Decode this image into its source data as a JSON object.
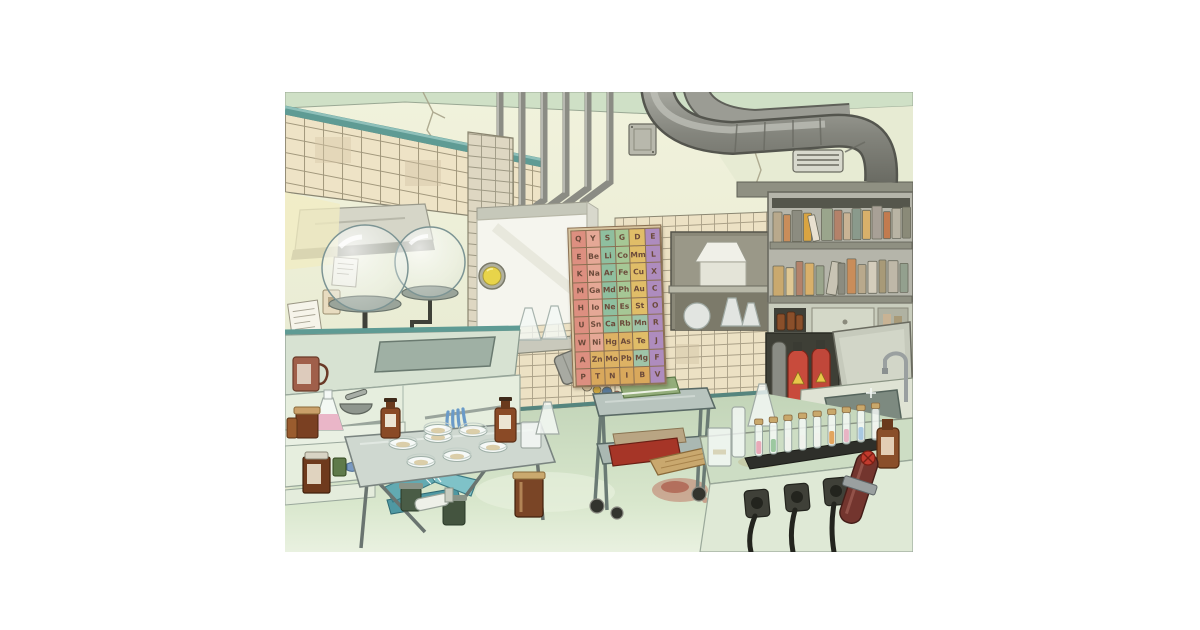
{
  "scene": {
    "title": "Laboratory illustration",
    "style": "watercolor cartoon",
    "setting": "old chemistry laboratory room with tiled walls, ducts, workbenches and glassware"
  },
  "palette": {
    "page_background": "#ffffff",
    "wall": "#eef0da",
    "wall_shadow": "#e3e7cd",
    "ceiling": "#cfe0c6",
    "tile": "#eee3c6",
    "tile_grout": "#958b70",
    "teal_trim": "#5f9b94",
    "metal": "#8b8c85",
    "metal_dark": "#5f6059",
    "counter": "#dde8d6",
    "cabinet": "#e6eede",
    "floor": "#c9dbbf",
    "extinguisher_red": "#c84b3c",
    "amber_glass": "#8a4f2a",
    "book_green": "#93ad7a",
    "book_teal": "#5fa8b0",
    "stain_red": "#b23a2a",
    "porthole_yellow": "#e8d44a",
    "agar": "#d8c9a0",
    "wood": "#c9a86e"
  },
  "poster": {
    "name": "letter-grid-wall-chart",
    "rows": 9,
    "columns": 6,
    "letter_color": "#6b4a3a",
    "column_colors": [
      "#dd8f80",
      "#e5a896",
      "#8fbf9f",
      "#a6c795",
      "#e0bd68",
      "#ae8cbe"
    ],
    "cell_overrides": [
      {
        "row": 5,
        "col": 4,
        "color": "#9fc4a8"
      },
      {
        "row": 6,
        "col": 2,
        "color": "#ddb264"
      },
      {
        "row": 6,
        "col": 3,
        "color": "#ddb264"
      },
      {
        "row": 7,
        "col": 1,
        "color": "#ddb264"
      },
      {
        "row": 7,
        "col": 2,
        "color": "#ddb264"
      },
      {
        "row": 7,
        "col": 3,
        "color": "#ddb264"
      },
      {
        "row": 7,
        "col": 4,
        "color": "#9fc4a8"
      },
      {
        "row": 8,
        "col": 1,
        "color": "#d9a85c"
      },
      {
        "row": 8,
        "col": 2,
        "color": "#d9a85c"
      },
      {
        "row": 8,
        "col": 3,
        "color": "#d9a85c"
      },
      {
        "row": 8,
        "col": 4,
        "color": "#d9a85c"
      }
    ],
    "grid": [
      [
        "Q",
        "Y",
        "S",
        "G",
        "D",
        "E"
      ],
      [
        "E",
        "Be",
        "Li",
        "Co",
        "Mm",
        "L"
      ],
      [
        "K",
        "Na",
        "Ar",
        "Fe",
        "Cu",
        "X"
      ],
      [
        "M",
        "Ga",
        "Md",
        "Ph",
        "Au",
        "C"
      ],
      [
        "H",
        "Io",
        "Ne",
        "Es",
        "St",
        "O"
      ],
      [
        "U",
        "Sn",
        "Ca",
        "Rb",
        "Mn",
        "R"
      ],
      [
        "W",
        "Ni",
        "Hg",
        "As",
        "Te",
        "J"
      ],
      [
        "A",
        "Zn",
        "Mo",
        "Pb",
        "Mg",
        "F"
      ],
      [
        "P",
        "T",
        "N",
        "I",
        "B",
        "V"
      ]
    ]
  },
  "bookshelf": {
    "row1_spines": [
      "#b9a98c",
      "#c98d5a",
      "#8c8c80",
      "#d9a441",
      "#e8e0d0",
      "#9aa58c",
      "#b4826a",
      "#c9b394",
      "#8a9a8c",
      "#d9b06a",
      "#a8a096",
      "#c27b4f",
      "#b9b4a4",
      "#8a8a78"
    ],
    "row2_spines": [
      "#caa96e",
      "#e0c894",
      "#b4826a",
      "#d9b06a",
      "#9aa58c",
      "#c9c4b4",
      "#8c8c80",
      "#c98d5a",
      "#b9a98c",
      "#d4cdbc",
      "#a89a78",
      "#bfb8a8",
      "#93a08e"
    ]
  },
  "test_tubes": {
    "liquid_colors": [
      "#e8aab8",
      "#9cc8a0",
      "#f0f2ec",
      "#f0f2ec",
      "#f0f2ec",
      "#e2a55e",
      "#e8b4c4",
      "#a9c9e2",
      "#f0f2ec"
    ]
  },
  "objects": [
    "ceiling-ducts",
    "conduit-pipes",
    "vent-grille",
    "fume-hood",
    "bell-jar-domes",
    "wall-notes",
    "light-switch",
    "left-sink-counter",
    "rubber-gloves",
    "mug",
    "porthole-machine",
    "flask-shelf",
    "letter-grid-wall-chart",
    "wall-niche-with-lamp-and-flasks",
    "bookshelf",
    "storage-cabinet",
    "gas-cylinder-cabinet",
    "fire-extinguishers",
    "steel-sink",
    "freezer-lid",
    "faucet",
    "console-bench",
    "test-tube-rack",
    "power-sockets",
    "mounted-cylinder",
    "wooden-plank",
    "beaker",
    "measuring-cylinder",
    "erlenmeyer-flask",
    "utility-cart",
    "green-book",
    "cart-books",
    "tipped-trash-can",
    "spilled-garbage",
    "floor-books",
    "red-floor-stain",
    "lab-table",
    "petri-dishes",
    "reagent-bottles",
    "back-counter",
    "pink-liquid-flask",
    "mortar-and-pestle",
    "jars"
  ]
}
